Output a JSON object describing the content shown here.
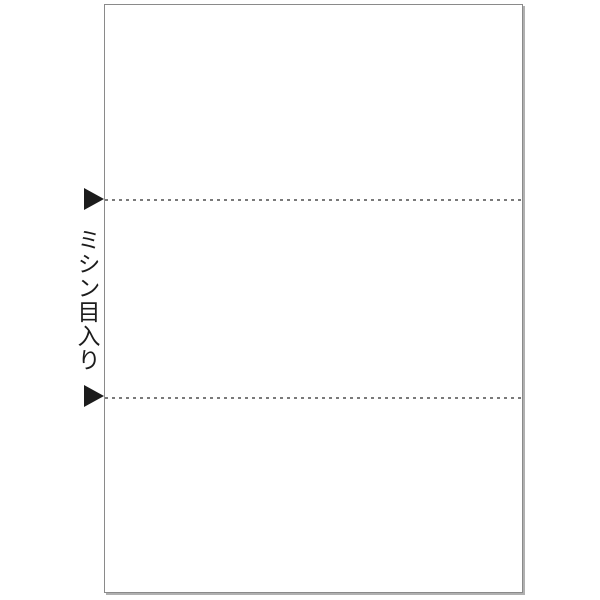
{
  "illustration": {
    "type": "product-feature-diagram",
    "subject": "A4 sheet with two horizontal perforation lines dividing it into three equal sections",
    "label": "ミシン目入り",
    "perforation_lines": {
      "count": 2,
      "style": "dashed",
      "positions_fraction_of_height": [
        0.33,
        0.67
      ]
    },
    "markers": {
      "count": 2,
      "shape": "right-pointing-triangle",
      "color": "#1c1c1c"
    },
    "colors": {
      "background": "#ffffff",
      "paper_fill": "#ffffff",
      "paper_border": "#8a8a8a",
      "paper_shadow": "#b0b0b0",
      "perforation_line": "#7a7a7a",
      "caption_text": "#1c1c1c"
    }
  }
}
